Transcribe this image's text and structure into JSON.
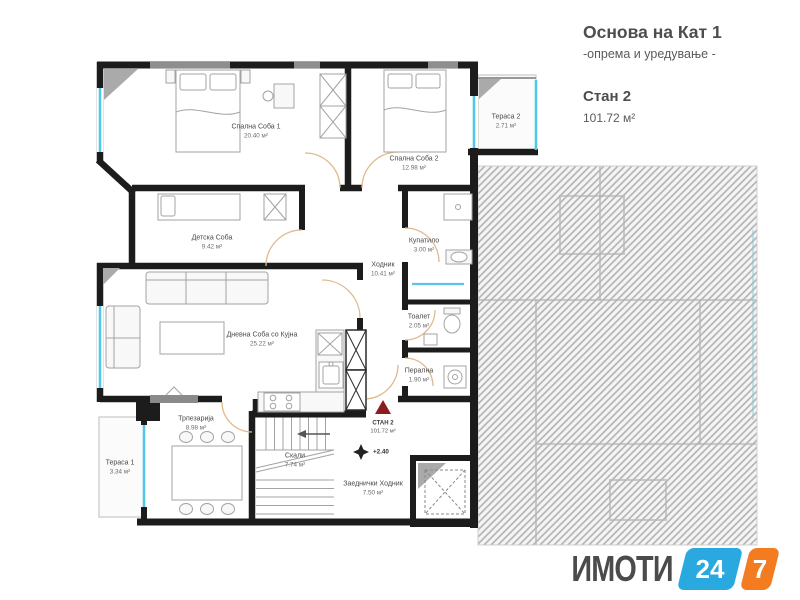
{
  "header": {
    "title": "Основа на Кат 1",
    "subtitle": "-опрема и уредување -",
    "apartment": "Стан 2",
    "area": "101.72 м²"
  },
  "rooms": [
    {
      "name": "Спална Соба 1",
      "area": "20.40 м²"
    },
    {
      "name": "Спална Соба 2",
      "area": "12.98 м²"
    },
    {
      "name": "Тераса 2",
      "area": "2.71 м²"
    },
    {
      "name": "Детска Соба",
      "area": "9.42 м²"
    },
    {
      "name": "Ходник",
      "area": "10.41 м²"
    },
    {
      "name": "Купатило",
      "area": "3.00 м²"
    },
    {
      "name": "Тоалет",
      "area": "2.05 м²"
    },
    {
      "name": "Перална",
      "area": "1.90 м²"
    },
    {
      "name": "Дневна Соба со Кујна",
      "area": "25.22 м²"
    },
    {
      "name": "Трпезарија",
      "area": "8.98 м²"
    },
    {
      "name": "Тераса 1",
      "area": "3.34 м²"
    },
    {
      "name": "Скали",
      "area": "7.74 м²"
    },
    {
      "name": "Заеднички Ходник",
      "area": "7.50 м²"
    }
  ],
  "markers": {
    "unit_label": "СТАН 2",
    "unit_area": "101.72 м²",
    "level": "+2.40"
  },
  "logo": {
    "brand": "ИМОТИ",
    "badge_left": "24",
    "badge_right": "7"
  },
  "colors": {
    "wall": "#1c1c1c",
    "window": "#54c6e8",
    "door_arc": "#dfba8c",
    "hatch_line": "#b6b6b6",
    "brand_blue": "#2aa9e0",
    "brand_orange": "#f47c20",
    "marker_red": "#8b1d1d",
    "text": "#4d4d4d"
  }
}
